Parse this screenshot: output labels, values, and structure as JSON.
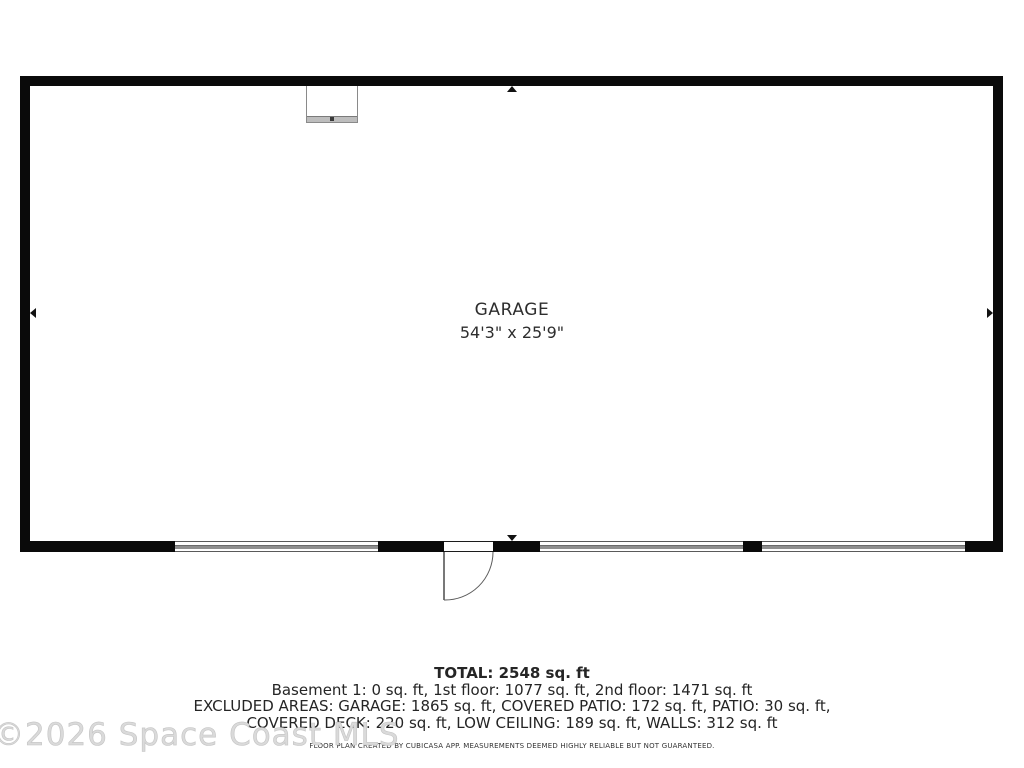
{
  "floorplan": {
    "room_label": "GARAGE",
    "room_dimensions": "54'3\" x 25'9\""
  },
  "summary": {
    "total": "TOTAL: 2548 sq. ft",
    "floors": "Basement 1: 0 sq. ft, 1st floor: 1077 sq. ft, 2nd floor: 1471 sq. ft",
    "excluded_line1": "EXCLUDED AREAS: GARAGE: 1865 sq. ft, COVERED PATIO: 172 sq. ft, PATIO: 30 sq. ft,",
    "excluded_line2": "COVERED DECK: 220 sq. ft, LOW CEILING: 189 sq. ft, WALLS: 312 sq. ft",
    "disclaimer": "FLOOR PLAN CREATED BY CUBICASA APP. MEASUREMENTS DEEMED HIGHLY RELIABLE BUT NOT GUARANTEED."
  },
  "watermark": {
    "text": "©2026 Space Coast MLS"
  },
  "colors": {
    "wall": "#0a0a0a",
    "garage_door_stripe": "#8f8f8f",
    "text": "#252525",
    "watermark": "#dadada"
  }
}
